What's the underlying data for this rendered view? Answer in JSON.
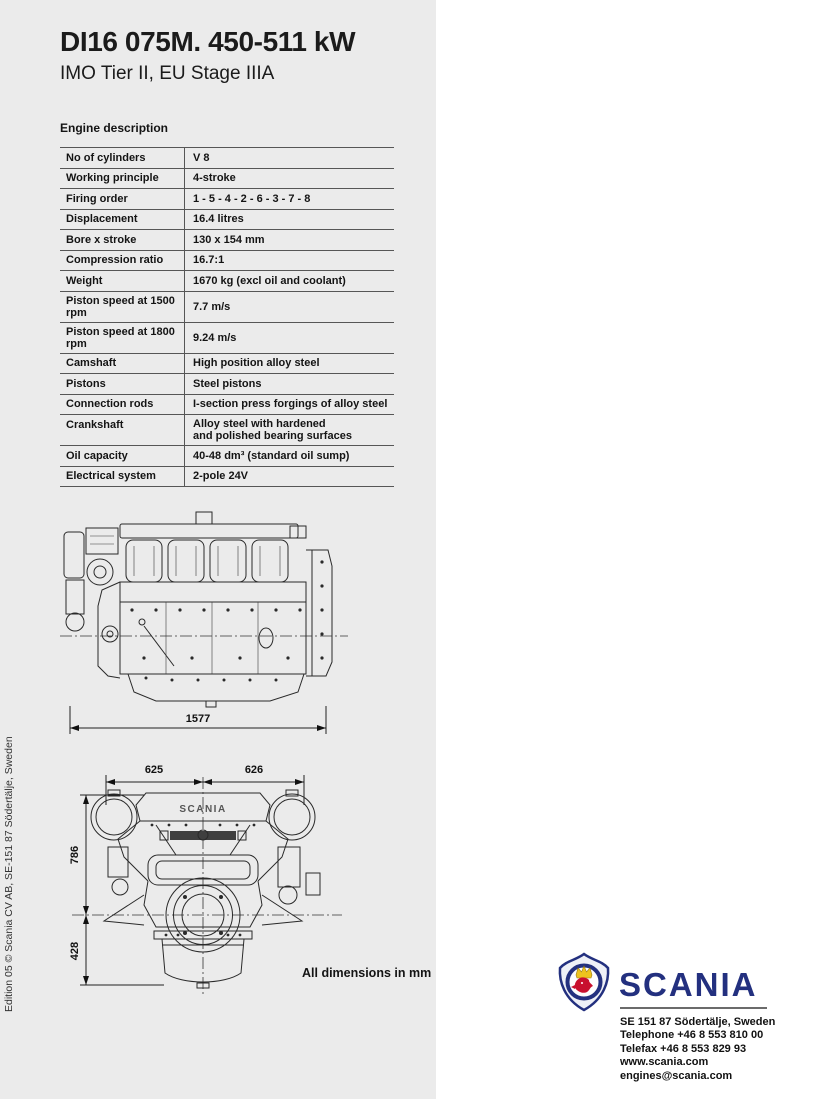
{
  "page": {
    "title": "DI16 075M. 450-511 kW",
    "subtitle": "IMO Tier II, EU Stage IIIA",
    "edition_note": "Edition 05 © Scania CV AB, SE-151 87  Södertälje, Sweden"
  },
  "engine_table": {
    "heading": "Engine description",
    "rows": [
      {
        "label": "No of cylinders",
        "value": "V 8"
      },
      {
        "label": "Working principle",
        "value": "4-stroke"
      },
      {
        "label": "Firing order",
        "value": "1 - 5 - 4 - 2 - 6 - 3 - 7 - 8"
      },
      {
        "label": "Displacement",
        "value": "16.4 litres"
      },
      {
        "label": "Bore x stroke",
        "value": "130 x 154 mm"
      },
      {
        "label": "Compression ratio",
        "value": "16.7:1"
      },
      {
        "label": "Weight",
        "value": "1670 kg (excl oil and coolant)"
      },
      {
        "label": "Piston speed at 1500 rpm",
        "value": "7.7 m/s"
      },
      {
        "label": "Piston speed at 1800 rpm",
        "value": "9.24 m/s"
      },
      {
        "label": "Camshaft",
        "value": "High position alloy steel"
      },
      {
        "label": "Pistons",
        "value": "Steel pistons"
      },
      {
        "label": "Connection rods",
        "value": "I-section press forgings of alloy steel"
      },
      {
        "label": "Crankshaft",
        "value": "Alloy steel with hardened",
        "value2": "and polished bearing surfaces"
      },
      {
        "label": "Oil capacity",
        "value": "40-48 dm³ (standard oil sump)"
      },
      {
        "label": "Electrical system",
        "value": "2-pole 24V"
      }
    ]
  },
  "drawings": {
    "side_view": {
      "length_dim": "1577"
    },
    "front_view": {
      "top_left_dim": "625",
      "top_right_dim": "626",
      "height_upper_dim": "786",
      "height_lower_dim": "428",
      "engine_label": "SCANIA"
    },
    "note": "All dimensions in mm"
  },
  "footer": {
    "brand": "SCANIA",
    "address": "SE 151 87  Södertälje, Sweden",
    "telephone": "Telephone +46 8 553 810 00",
    "telefax": "Telefax +46 8 553 829 93",
    "website": "www.scania.com",
    "email": "engines@scania.com"
  },
  "colors": {
    "page_gray": "#ebebeb",
    "scania_blue": "#23307f",
    "griffin_red": "#c8102e",
    "crown_gold": "#eec31e"
  }
}
